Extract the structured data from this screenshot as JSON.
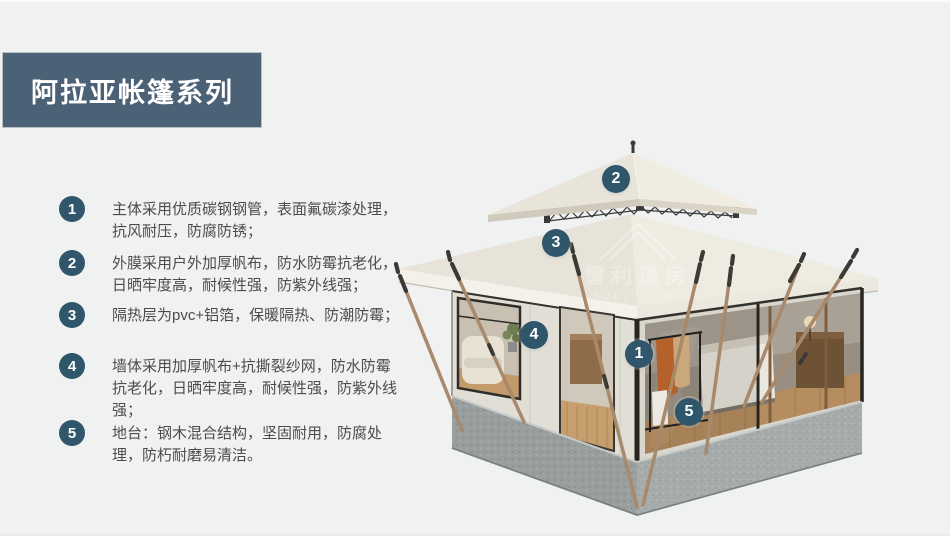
{
  "title": "阿拉亚帐篷系列",
  "features": [
    {
      "num": "1",
      "text": "主体采用优质碳钢钢管，表面氟碳漆处理，抗风耐压，防腐防锈；"
    },
    {
      "num": "2",
      "text": "外膜采用户外加厚帆布，防水防霉抗老化，日晒牢度高，耐候性强，防紫外线强；"
    },
    {
      "num": "3",
      "text": "隔热层为pvc+铝箔，保暖隔热、防潮防霉；"
    },
    {
      "num": "4",
      "text": "墙体采用加厚帆布+抗撕裂纱网，防水防霉抗老化，日晒牢度高，耐候性强，防紫外线强；"
    },
    {
      "num": "5",
      "text": "地台：钢木混合结构，坚固耐用，防腐处理，防朽耐磨易清洁。"
    }
  ],
  "markers": [
    {
      "label": "1"
    },
    {
      "label": "2"
    },
    {
      "label": "3"
    },
    {
      "label": "4"
    },
    {
      "label": "5"
    }
  ],
  "watermark": {
    "cn": "雪利篷房",
    "en": "XUELI TENT"
  },
  "colors": {
    "accent": "#4b6276",
    "badge": "#30566b",
    "text": "#4c4c4c",
    "background": "#f0f1f1",
    "roof": "#efece3",
    "canvas": "#e0ddd4"
  }
}
